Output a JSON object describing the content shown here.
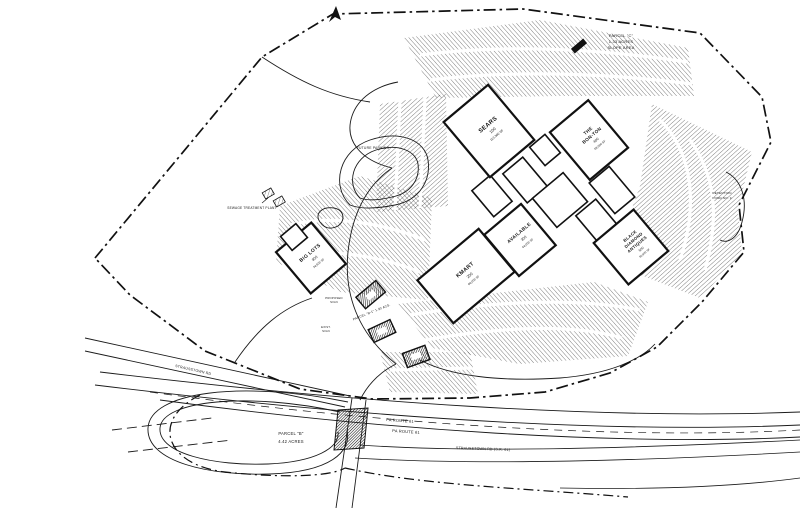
{
  "buildings": {
    "sears": {
      "name": "SEARS",
      "num": "100",
      "area": "113,300 SF"
    },
    "bon_ton": {
      "l1": "THE",
      "l2": "BON-TON",
      "num": "400",
      "area": "58,000 SF"
    },
    "available": {
      "name": "AVAILABLE",
      "num": "300",
      "area": "44,000 SF"
    },
    "black_diamond": {
      "l1": "BLACK",
      "l2": "DIAMOND",
      "l3": "ANTIQUES",
      "num": "500",
      "area": "56,800 SF"
    },
    "kmart": {
      "name": "KMART",
      "num": "200",
      "area": "86,000 SF"
    },
    "big_lots": {
      "name": "BIG LOTS",
      "num": "900",
      "area": "34,500 SF"
    }
  },
  "labels": {
    "future_parking": "FUTURE PARKING",
    "parcel_c_1": "PARCEL \"C\"",
    "parcel_c_2": "1.33 ACRES",
    "parcel_c_3": "SLOPE AREA",
    "detention_1": "DETENTION",
    "detention_2": "POND NO. 3",
    "sewage_plant": "SEWAGE TREATMENT PLANT",
    "parcel_b_1": "PARCEL \"B\"",
    "parcel_b_2": "4.42 ACRES",
    "parcel_b1": "PARCEL \"B-1\"  1.30 ACS.",
    "pa_route_61_a": "PA ROUTE 61",
    "pa_route_61_b": "PA ROUTE 61",
    "strausstown_west": "STRAUSSTOWN RD",
    "strausstown_south": "STRAUSSTOWN RD  (S.R. 61)",
    "proposed_sign_1": "PROPOSED",
    "proposed_sign_2": "SIGN",
    "exist_sign_1": "EXIST.",
    "exist_sign_2": "SIGN"
  }
}
